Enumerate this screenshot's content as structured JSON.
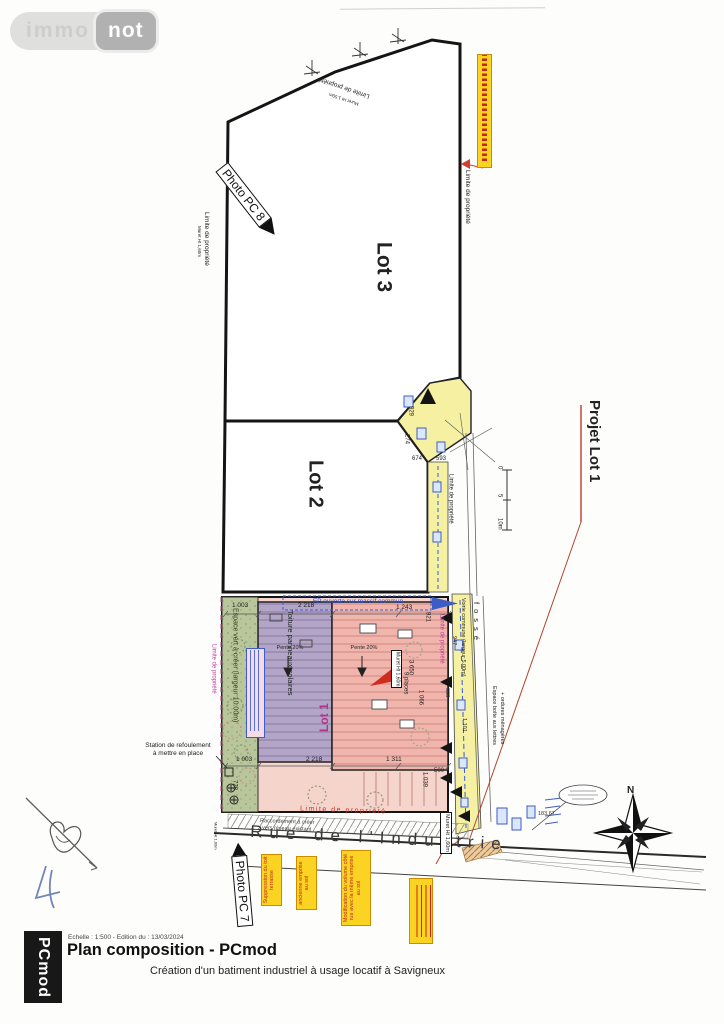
{
  "logo": {
    "immo": "immo",
    "not": "not"
  },
  "lots": {
    "l1": "Lot 1",
    "l2": "Lot 2",
    "l3": "Lot 3",
    "projet": "Projet Lot 1"
  },
  "photos": {
    "pc7": "Photo PC 7",
    "pc8": "Photo PC 8"
  },
  "labels": {
    "limite": "Limite de propriété",
    "limite_red": "Limite de proprieté",
    "muret160": "Muret Ht 1,60m",
    "muret150": "Muret Ht 1.50m",
    "voirie": "Voirie commune (largeur 5.00m)",
    "fosse": "fossé",
    "boite1": "Espace boîte aux lettres",
    "boite2": "+ ordures ménagères",
    "espace_vert": "Espace vert à créer (largeur 10.00m)",
    "toiture": "Toiture panneaux solaires",
    "pente": "Pente 20%",
    "places": "9 places",
    "ep": "EP ouverte sur massif commun",
    "station1": "Station de refoulement",
    "station2": "à mettre en place",
    "racc1": "Raccordement à créer",
    "racc2": "vers réseau existant",
    "rue": "Rue de l'Industrie",
    "elev": "183.67",
    "north": "N"
  },
  "notes": {
    "n1": "Suppression du toit terrasse",
    "n2": "ancienne emprise au sol",
    "n3": "Modification du volume côté rue avec la même emprise au sol"
  },
  "dims": {
    "d1003": "1 003",
    "d2218": "2 218",
    "d1243": "1 243",
    "d921": "921",
    "d929": "929",
    "d274": "274",
    "d674": "674",
    "d593": "593",
    "d947": "947",
    "d638": "638",
    "d3650": "3 650",
    "d1066": "1 066",
    "d1311": "1 311",
    "d1039": "1 039",
    "d728": "728",
    "d500": "500",
    "d1101": "1 101",
    "d3669": "3 669"
  },
  "scale": {
    "s0": "0",
    "s5": "5",
    "s10": "10m"
  },
  "titleblock": {
    "brand": "PCmod",
    "meta": "Echelle : 1:500  - Edition du : 13/03/2024",
    "title": "Plan composition - PCmod",
    "subtitle": "Création d'un batiment industriel à usage locatif à Savigneux"
  }
}
